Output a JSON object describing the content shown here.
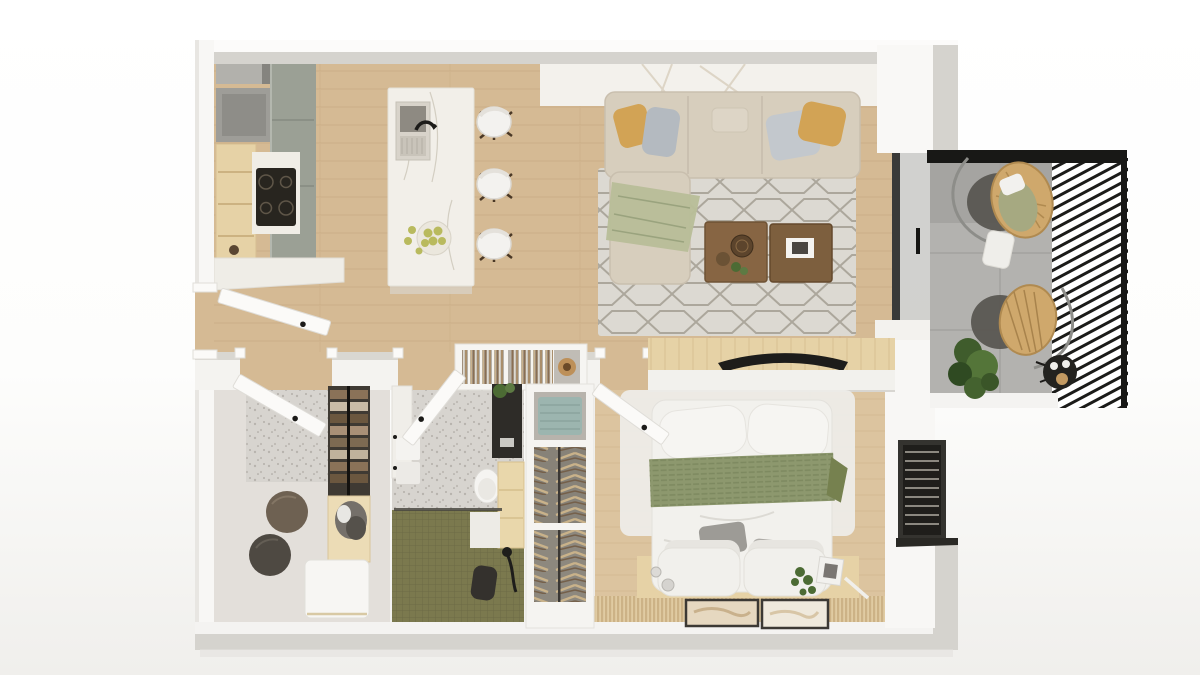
{
  "meta": {
    "image_kind": "photorealistic top-down 3D floor plan render",
    "subject": "one-bedroom apartment with balcony",
    "visible_text": ""
  },
  "palette": {
    "pageBg": "#ffffff",
    "wallBand": "#d5d3ce",
    "wallFace": "#f4f3f0",
    "woodLiving": "#d5ba94",
    "woodBedroom": "#dcc49f",
    "sofaBody": "#d7cebd",
    "pillowYellow": "#d2a355",
    "pillowGray": "#b4bac0",
    "throwGreen": "#b8bd98",
    "tableWood": "#876543",
    "marble": "#f0ede6",
    "sage": "#9ba095",
    "cabinetWood": "#e6d2a6",
    "islandMarble": "#f2efe9",
    "rugBase": "#dcd9d2",
    "balconyFloor": "#b3b2af",
    "railBlack": "#1c1c1a",
    "rattan": "#cfa86c",
    "cushionGreen": "#a6a981",
    "plantGreen": "#4c6b34",
    "terrazzo": "#d7d4cf",
    "tileGreen": "#7b794e",
    "blanketGreen": "#8d986e",
    "bedWhite": "#f2f1ed",
    "matTan": "#dcc69d",
    "closetFloor": "#e3dfda",
    "darkFixture": "#2e2c28",
    "tealTowel": "#9cb5af",
    "dresserWhite": "#f7f6f3",
    "frameDark": "#3c3934"
  },
  "scene": {
    "rooms": [
      {
        "name": "kitchen",
        "items": [
          "upper-cabinets",
          "sage-cabinet-column",
          "cooktop-counter",
          "open-wood-cabinet",
          "marble-island-with-sink",
          "fruit-bowl",
          "three-bar-stools"
        ]
      },
      {
        "name": "living-room",
        "items": [
          "sectional-sofa-with-chaise",
          "yellow-and-gray-pillows",
          "green-throw",
          "geometric-rug",
          "two-wood-coffee-tables",
          "console-with-art"
        ]
      },
      {
        "name": "balcony",
        "items": [
          "two-rattan-hanging-chairs",
          "round-dark-rugs",
          "floor-pillow",
          "black-side-table",
          "plant",
          "slatted-black-railing",
          "glass-sliding-door"
        ]
      },
      {
        "name": "walk-in-closet",
        "items": [
          "two-dark-pouffes",
          "clothes-shelves",
          "basket-unit",
          "white-dresser"
        ]
      },
      {
        "name": "bathroom",
        "items": [
          "towel-rail",
          "black-vanity-with-plant",
          "toilet",
          "wood-shelf",
          "green-tiled-shower",
          "black-stool",
          "shower-fixture"
        ]
      },
      {
        "name": "hallway",
        "items": [
          "entry-door",
          "bookshelf-console",
          "wardrobe-column-with-hanging-clothes"
        ]
      },
      {
        "name": "bedroom",
        "items": [
          "double-bed-green-blanket",
          "white-rug",
          "tv-wall",
          "headboard-shelf-decor",
          "bamboo-mat",
          "two-framed-artworks",
          "louvered-window"
        ]
      }
    ]
  }
}
